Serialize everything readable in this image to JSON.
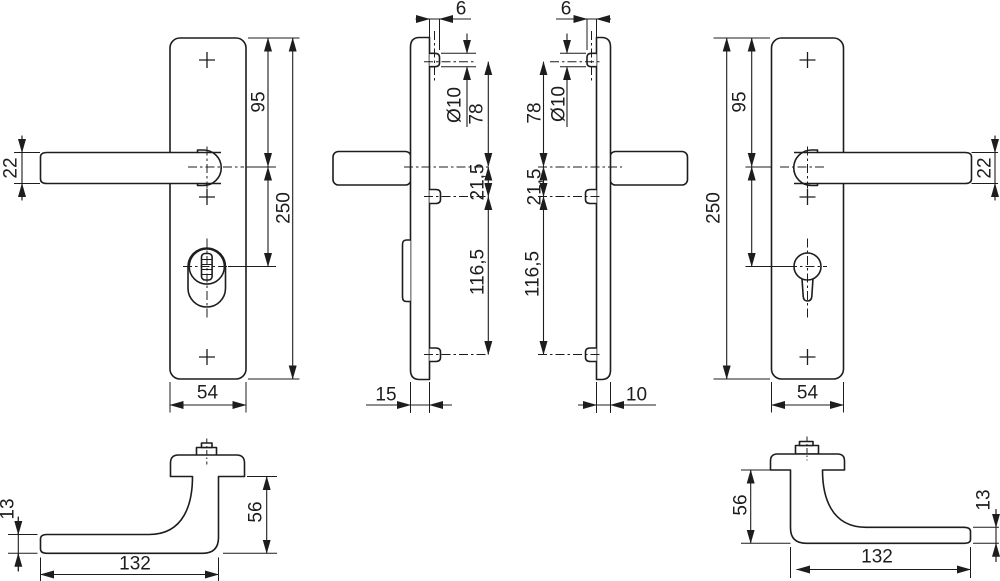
{
  "drawing_type": "technical-drawing-door-handle-security-fitting",
  "colors": {
    "line": "#1d1d1d",
    "background": "#ffffff"
  },
  "views": {
    "front_left": {
      "label": "front view left handle",
      "dims": {
        "lever_thickness": "22",
        "backplate_top_to_handle": "95",
        "backplate_height": "250",
        "backplate_width": "54"
      }
    },
    "side_left": {
      "label": "side view left handle",
      "dims": {
        "screw_standout": "6",
        "screw_head_diameter": "Ø10",
        "screw_to_handle_axis": "78",
        "handle_axis_to_screw": "21,5",
        "screw_spacing": "116,5",
        "backplate_depth": "15"
      }
    },
    "side_right": {
      "label": "side view right handle",
      "dims": {
        "screw_standout": "6",
        "screw_head_diameter": "Ø10",
        "screw_to_handle_axis": "78",
        "handle_axis_to_screw": "21,5",
        "screw_spacing": "116,5",
        "backplate_depth": "10"
      }
    },
    "front_right": {
      "label": "front view right handle",
      "dims": {
        "backplate_top_to_handle": "95",
        "backplate_height": "250",
        "lever_thickness": "22",
        "backplate_width": "54"
      }
    },
    "top_left": {
      "label": "top view left handle",
      "dims": {
        "grip_depth": "13",
        "handle_projection": "56",
        "handle_length": "132"
      }
    },
    "top_right": {
      "label": "top view right handle",
      "dims": {
        "handle_projection": "56",
        "grip_depth": "13",
        "handle_length": "132"
      }
    }
  }
}
